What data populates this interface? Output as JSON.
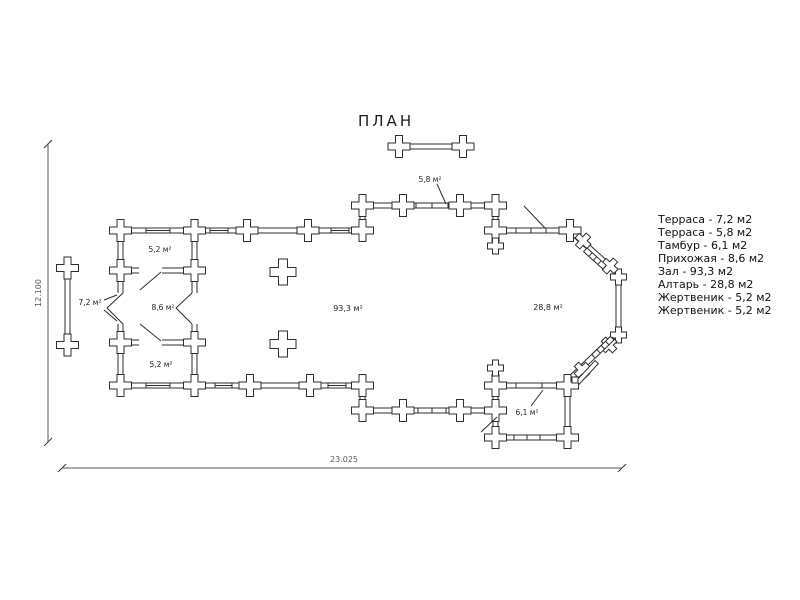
{
  "window": {
    "title": "ПЛАН"
  },
  "plan": {
    "room_labels": {
      "terrace_left": "7,2 м²",
      "terrace_top": "5,8 м²",
      "sanctuary_top": "5,2 м²",
      "vestibule": "8,6 м²",
      "sanctuary_bottom": "5,2 м²",
      "hall": "93,3 м²",
      "altar": "28,8 м²",
      "tambour": "6,1 м²"
    },
    "dimensions": {
      "horizontal": "23.025",
      "vertical": "12.100"
    },
    "colors": {
      "wall_line": "#2e2e2e",
      "dimension_line": "#8c8c8c",
      "background": "#ffffff"
    }
  },
  "legend": {
    "items": [
      "Терраса - 7,2 м2",
      "Терраса - 5,8 м2",
      "Тамбур - 6,1 м2",
      "Прихожая - 8,6 м2",
      "Зал - 93,3 м2",
      "Алтарь - 28,8 м2",
      "Жертвеник - 5,2 м2",
      "Жертвеник - 5,2 м2"
    ]
  }
}
